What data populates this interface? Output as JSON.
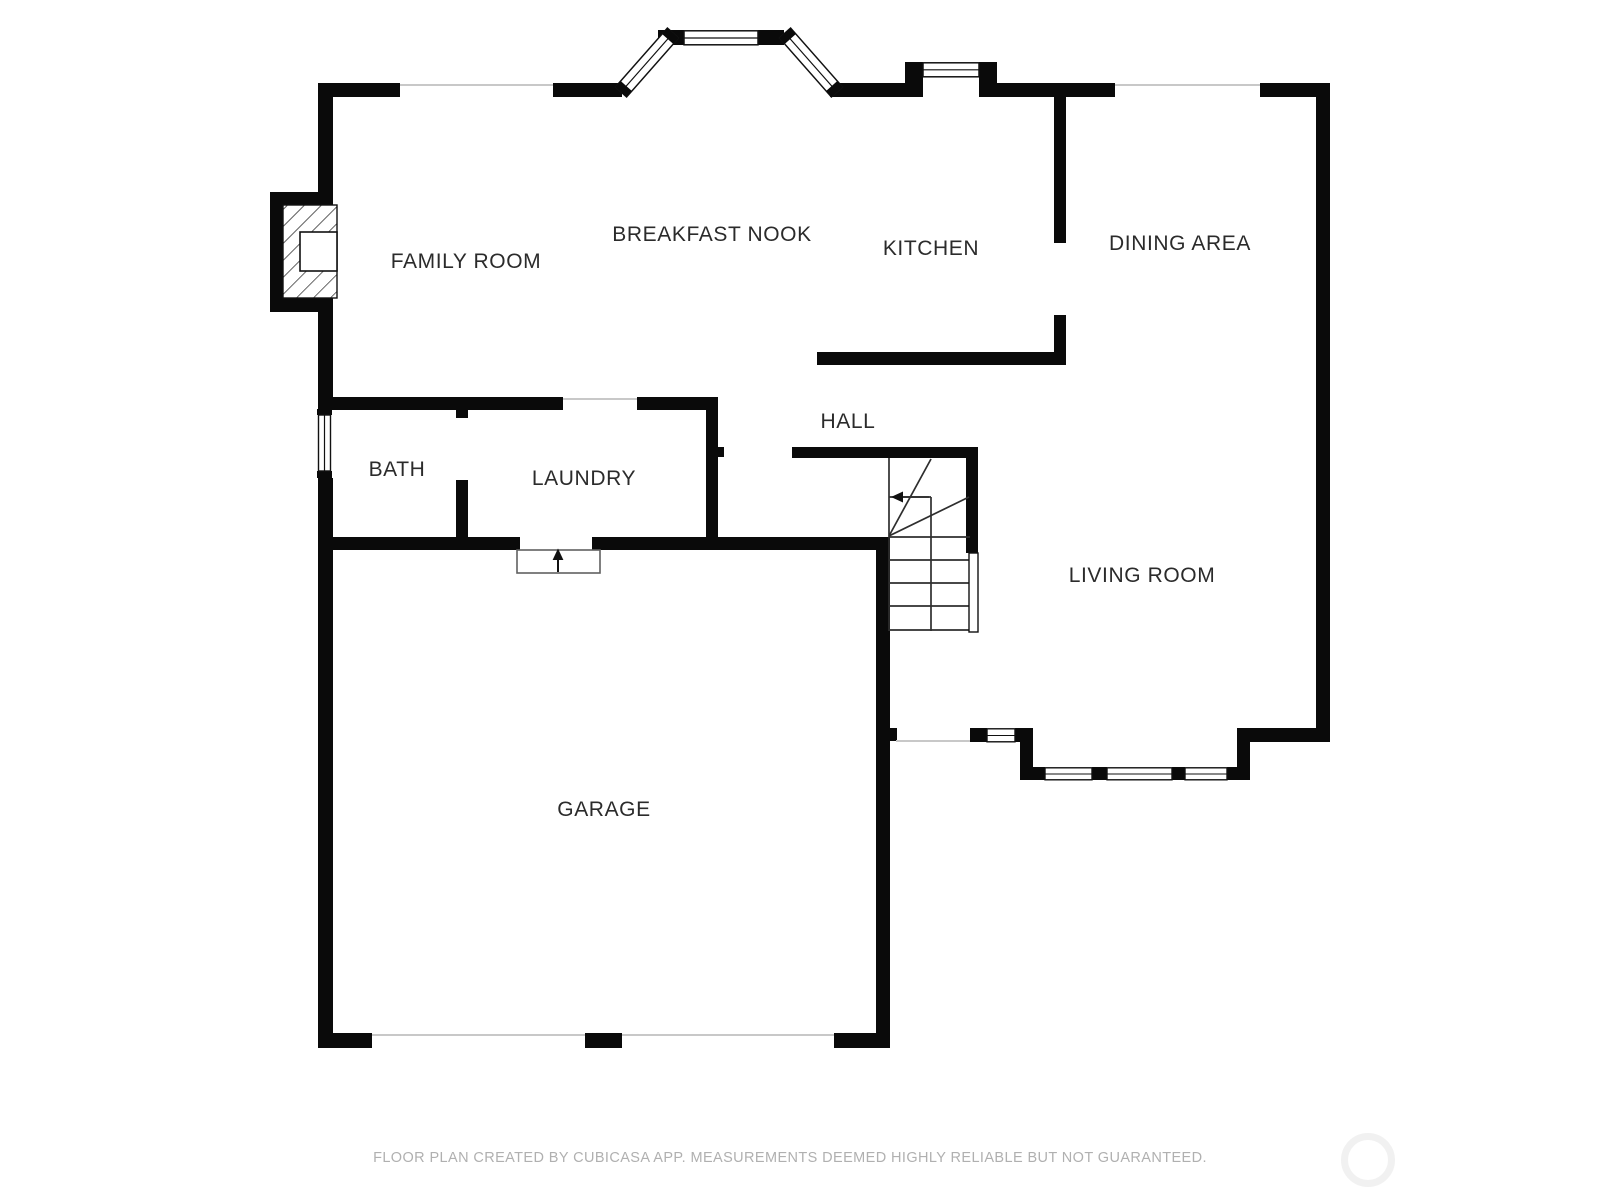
{
  "document": {
    "type": "floor-plan",
    "creator_note": "FLOOR PLAN CREATED BY CUBICASA APP. MEASUREMENTS DEEMED HIGHLY RELIABLE BUT NOT GUARANTEED."
  },
  "rooms": [
    {
      "id": "family-room",
      "label": "FAMILY ROOM"
    },
    {
      "id": "breakfast-nook",
      "label": "BREAKFAST NOOK"
    },
    {
      "id": "kitchen",
      "label": "KITCHEN"
    },
    {
      "id": "dining-area",
      "label": "DINING AREA"
    },
    {
      "id": "bath",
      "label": "BATH"
    },
    {
      "id": "laundry",
      "label": "LAUNDRY"
    },
    {
      "id": "hall",
      "label": "HALL"
    },
    {
      "id": "living-room",
      "label": "LIVING ROOM"
    },
    {
      "id": "garage",
      "label": "GARAGE"
    }
  ],
  "footer": {
    "disclaimer": "FLOOR PLAN CREATED BY CUBICASA APP. MEASUREMENTS DEEMED HIGHLY RELIABLE BUT NOT GUARANTEED."
  },
  "symbols": [
    "bay-window",
    "window",
    "fireplace",
    "stairs-with-direction-arrow",
    "entry-door-arrow",
    "garage-door-openings",
    "watermark-circle"
  ],
  "colors": {
    "wall": "#0a0a0a",
    "label_text": "#2b2b2b",
    "footer_text": "#b0b0b0",
    "opening_line": "#c8c8c8",
    "background": "#ffffff",
    "watermark_circle": "#f1f1f1"
  }
}
